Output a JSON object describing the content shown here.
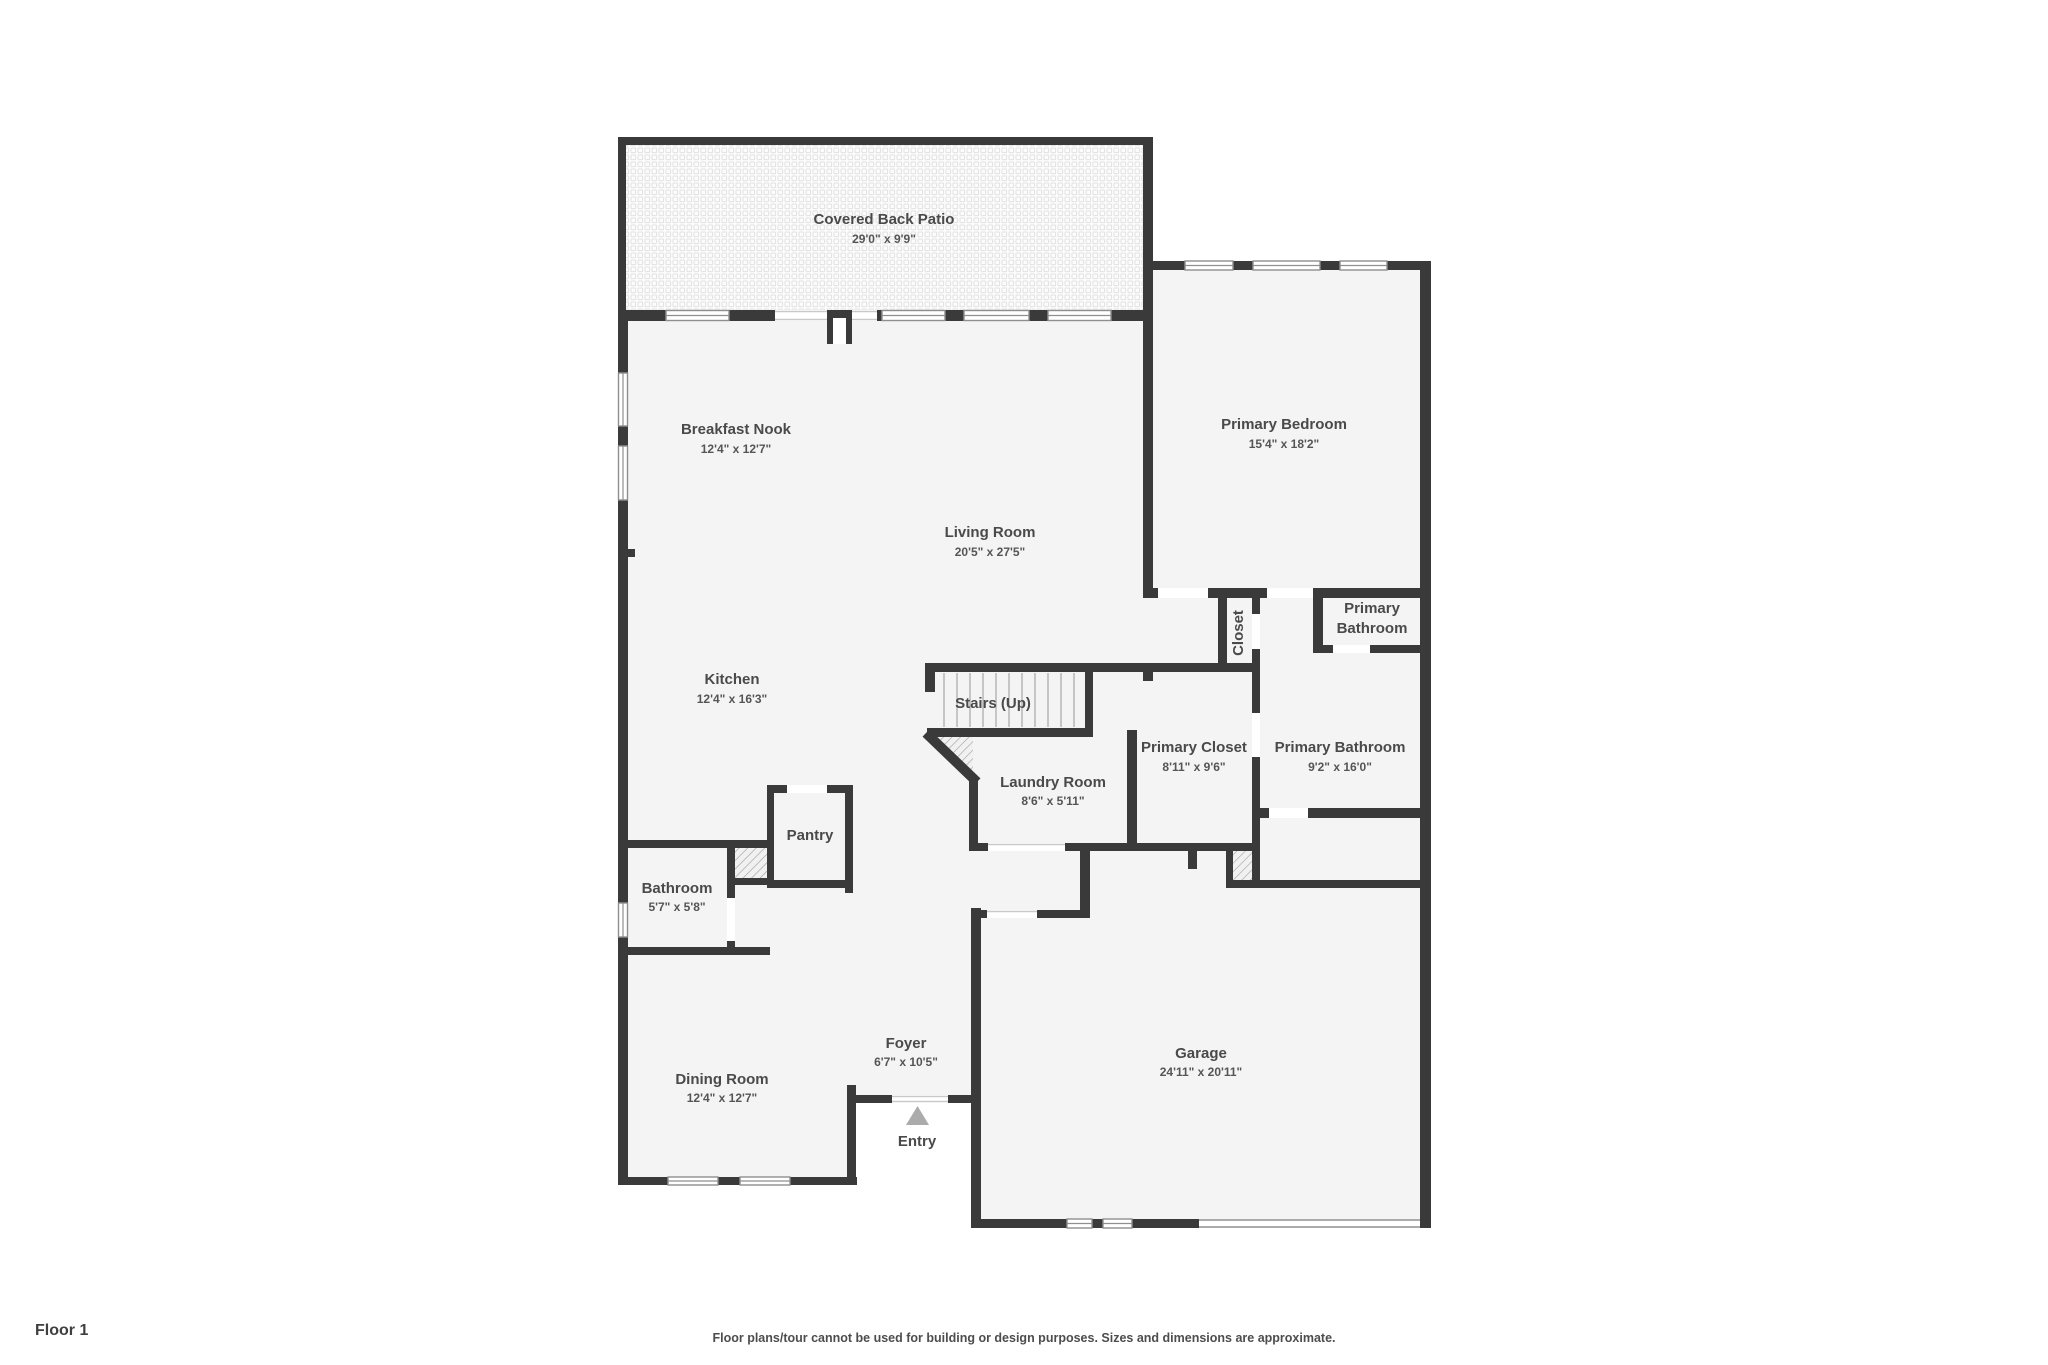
{
  "title": "Floor plan - Floor 1",
  "colors": {
    "wall": "#3a3a3a",
    "room_fill": "#f4f4f4",
    "patio_pattern": "#e2e2e2",
    "window_frame": "#8f8f8f",
    "opening_line": "#c9c9c9",
    "hatch_line": "#9f9f9f",
    "label_text": "#4a4a4a",
    "entry_triangle": "#ababab"
  },
  "rooms": [
    {
      "id": "covered-back-patio",
      "name": "Covered Back Patio",
      "dims": "29'0\" x 9'9\""
    },
    {
      "id": "primary-bedroom",
      "name": "Primary Bedroom",
      "dims": "15'4\" x 18'2\""
    },
    {
      "id": "breakfast-nook",
      "name": "Breakfast Nook",
      "dims": "12'4\" x 12'7\""
    },
    {
      "id": "living-room",
      "name": "Living Room",
      "dims": "20'5\" x 27'5\""
    },
    {
      "id": "kitchen",
      "name": "Kitchen",
      "dims": "12'4\" x 16'3\""
    },
    {
      "id": "closet",
      "name": "Closet",
      "dims": ""
    },
    {
      "id": "primary-bathroom-upper",
      "name": "Primary Bathroom",
      "dims": "",
      "lines": [
        "Primary",
        "Bathroom"
      ]
    },
    {
      "id": "stairs",
      "name": "Stairs (Up)",
      "dims": ""
    },
    {
      "id": "primary-closet",
      "name": "Primary Closet",
      "dims": "8'11\" x 9'6\""
    },
    {
      "id": "primary-bathroom",
      "name": "Primary Bathroom",
      "dims": "9'2\" x 16'0\""
    },
    {
      "id": "laundry-room",
      "name": "Laundry Room",
      "dims": "8'6\" x 5'11\""
    },
    {
      "id": "pantry",
      "name": "Pantry",
      "dims": ""
    },
    {
      "id": "bathroom",
      "name": "Bathroom",
      "dims": "5'7\" x 5'8\""
    },
    {
      "id": "dining-room",
      "name": "Dining Room",
      "dims": "12'4\" x 12'7\""
    },
    {
      "id": "foyer",
      "name": "Foyer",
      "dims": "6'7\" x 10'5\""
    },
    {
      "id": "garage",
      "name": "Garage",
      "dims": "24'11\" x 20'11\""
    },
    {
      "id": "entry",
      "name": "Entry",
      "dims": ""
    }
  ],
  "footer": {
    "floor_label": "Floor 1",
    "disclaimer": "Floor plans/tour cannot be used for building or design purposes. Sizes and dimensions are approximate."
  }
}
